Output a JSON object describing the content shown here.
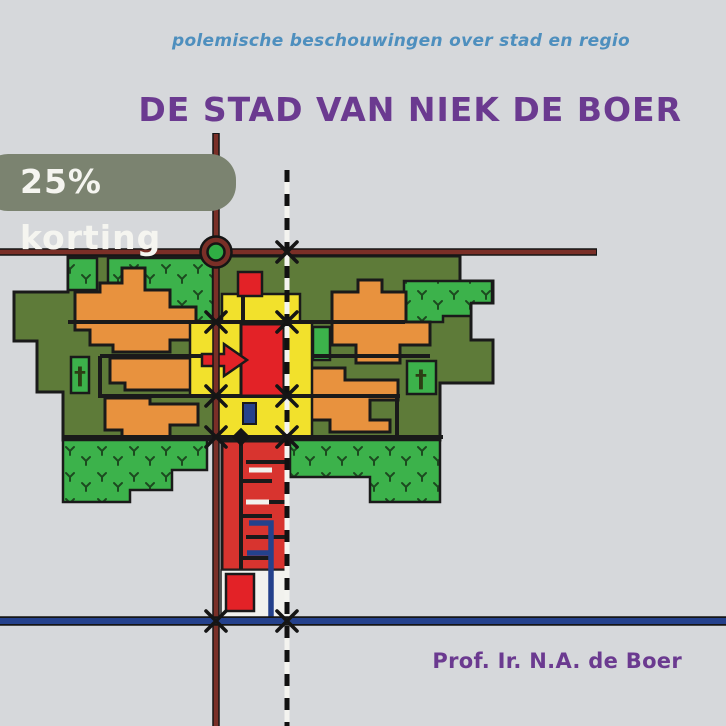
{
  "page": {
    "background_color": "#d6d8db"
  },
  "cover": {
    "subtitle": "polemische beschouwingen over stad en regio",
    "title": "DE STAD VAN NIEK DE BOER",
    "author": "Prof. Ir. N.A. de Boer"
  },
  "badge": {
    "label": "25% korting"
  },
  "illustration": {
    "type": "stylized city plan diagram (urbanism scheme)",
    "icons": {
      "church_cross": "†",
      "roundabout": "circle",
      "direction_arrow": "right-arrow",
      "crossing_marker": "x-mark"
    },
    "colors": {
      "district_olive": "#5e7b39",
      "park_green": "#3cb24b",
      "housing_orange": "#e8923e",
      "center_yellow": "#f2e12c",
      "accent_red": "#e32227",
      "road_dark_red": "#7a2f27",
      "water_blue": "#24418c",
      "street_black": "#1a1a1a",
      "badge_olive": "#7b8370",
      "title_purple": "#6b3a90",
      "subtitle_blue": "#4e8fbe"
    }
  }
}
